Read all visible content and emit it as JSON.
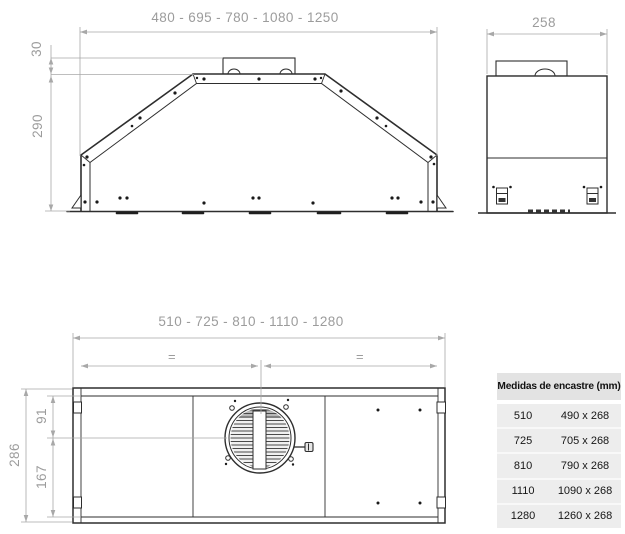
{
  "front_view": {
    "width_label": "480 - 695 - 780 - 1080 - 1250",
    "duct_height_label": "30",
    "height_label": "290"
  },
  "side_view": {
    "depth_label": "258"
  },
  "bottom_view": {
    "width_label": "510 - 725 - 810 - 1110 - 1280",
    "depth_label": "286",
    "fan_center_front_label": "91",
    "fan_center_rear_label": "167",
    "equal_spacing_left": "=",
    "equal_spacing_right": "="
  },
  "cutout_table": {
    "header": "Medidas de encastre (mm)",
    "rows": [
      {
        "width": "510",
        "cutout": "490 x 268"
      },
      {
        "width": "725",
        "cutout": "705 x 268"
      },
      {
        "width": "810",
        "cutout": "790 x 268"
      },
      {
        "width": "1110",
        "cutout": "1090 x 268"
      },
      {
        "width": "1280",
        "cutout": "1260 x 268"
      }
    ]
  },
  "colors": {
    "drawing_line": "#2e2e2e",
    "dimension_line": "#a8a8a8",
    "dimension_text": "#9c9c9c",
    "table_header_bg": "#e3e3e3",
    "table_row_bg": "#ededed"
  }
}
